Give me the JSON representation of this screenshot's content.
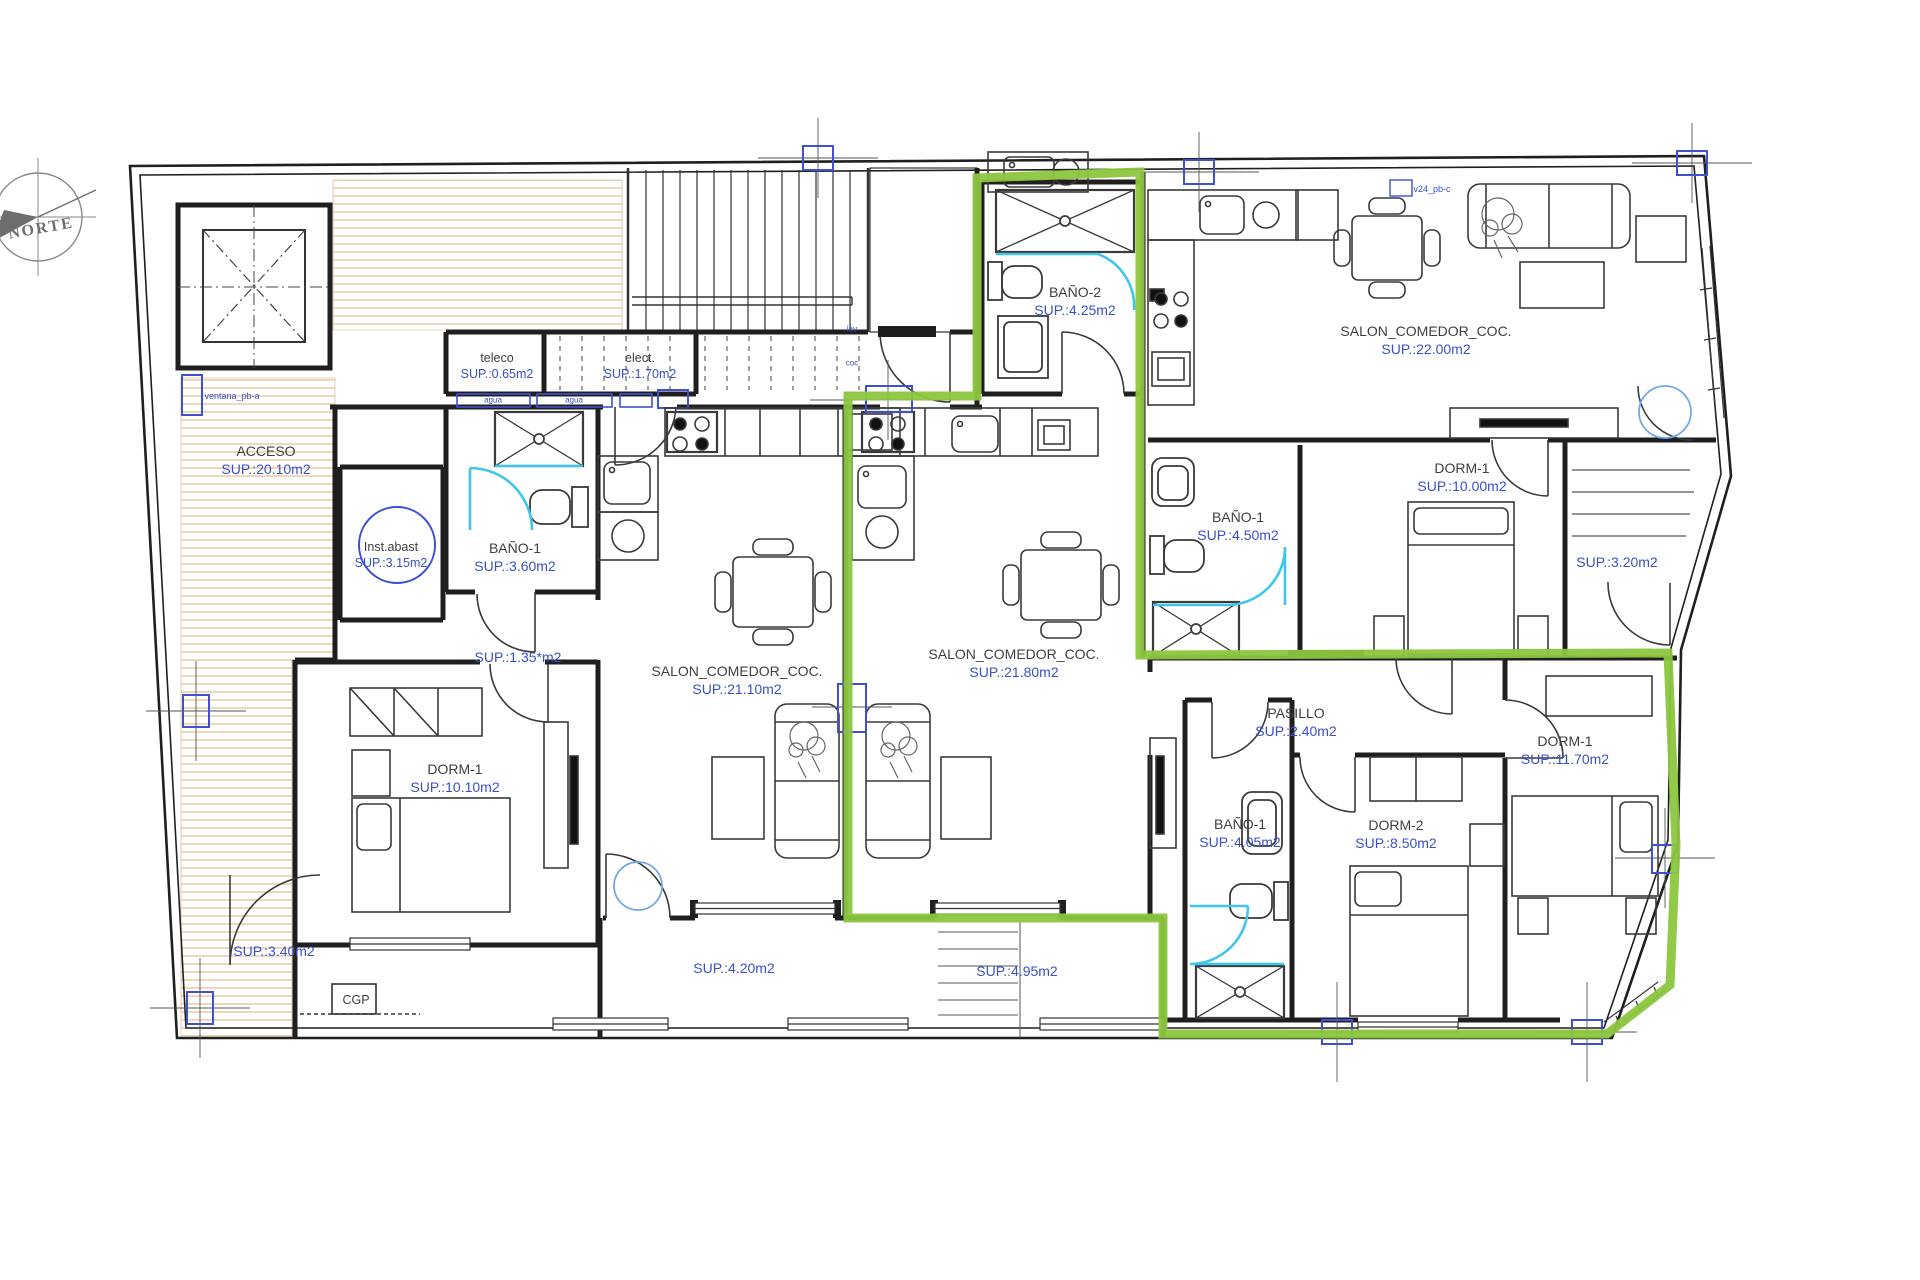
{
  "document": {
    "type": "architectural floor plan",
    "highlighted_unit": "middle apartment outlined in green"
  },
  "compass": {
    "label": "NORTE"
  },
  "colors": {
    "highlight_green": "#8dc63f",
    "area_text_blue": "#3b50c8",
    "hatch_tan": "#e7c8a0",
    "fixture_cyan": "#3fc6ea",
    "marker_blue": "#3f51d1",
    "wall_black": "#1f1f1f",
    "door_circle_blue": "#74a9e6"
  },
  "rooms": {
    "acceso": {
      "name": "ACCESO",
      "area": "SUP.:20.10m2"
    },
    "teleco": {
      "name": "teleco",
      "area": "SUP.:0.65m2"
    },
    "elect": {
      "name": "elect.",
      "area": "SUP.:1.70m2"
    },
    "inst_abast": {
      "name": "Inst.abast",
      "area": "SUP.:3.15m2"
    },
    "bano1_a": {
      "name": "BAÑO-1",
      "area": "SUP.:3.60m2"
    },
    "hall_a": {
      "area": "SUP.:1.35*m2"
    },
    "salon_a": {
      "name": "SALON_COMEDOR_COC.",
      "area": "SUP.:21.10m2"
    },
    "dorm1_a": {
      "name": "DORM-1",
      "area": "SUP.:10.10m2"
    },
    "patio_a": {
      "area": "SUP.:3.40m2"
    },
    "terrace_a": {
      "area": "SUP.:4.20m2"
    },
    "cgp": {
      "name": "CGP"
    },
    "bano2_b": {
      "name": "BAÑO-2",
      "area": "SUP.:4.25m2"
    },
    "salon_b": {
      "name": "SALON_COMEDOR_COC.",
      "area": "SUP.:21.80m2"
    },
    "pasillo_b": {
      "name": "PASILLO",
      "area": "SUP.:2.40m2"
    },
    "bano1_b": {
      "name": "BAÑO-1",
      "area": "SUP.:4.05m2"
    },
    "dorm2_b": {
      "name": "DORM-2",
      "area": "SUP.:8.50m2"
    },
    "dorm1_b": {
      "name": "DORM-1",
      "area": "SUP.:11.70m2"
    },
    "terrace_b": {
      "area": "SUP.:4.95m2"
    },
    "salon_c": {
      "name": "SALON_COMEDOR_COC.",
      "area": "SUP.:22.00m2"
    },
    "bano1_c": {
      "name": "BAÑO-1",
      "area": "SUP.:4.50m2"
    },
    "dorm1_c": {
      "name": "DORM-1",
      "area": "SUP.:10.00m2"
    },
    "balcony_c": {
      "area": "SUP.:3.20m2"
    }
  },
  "annotations": {
    "window_tag_left": "ventana_pb-a",
    "window_tag_top": "v24_pb-c",
    "meter_label": "agua",
    "plumb_lav": "lav",
    "plumb_coc": "coc"
  }
}
